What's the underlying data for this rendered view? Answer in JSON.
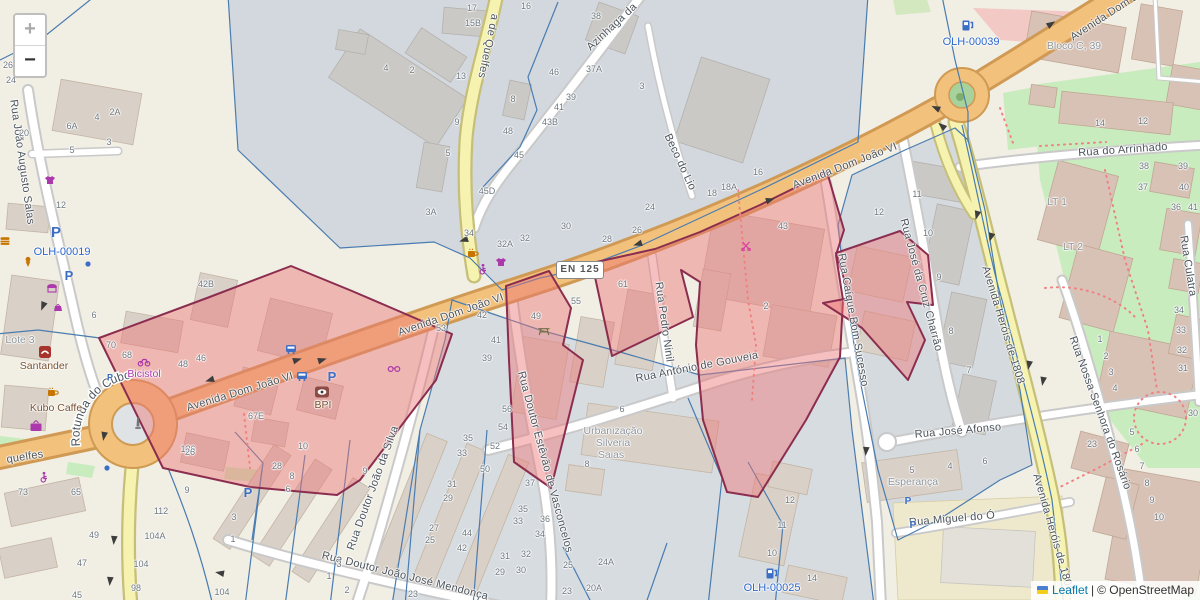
{
  "map": {
    "controls": {
      "zoom_in": "+",
      "zoom_out": "−"
    },
    "attribution": {
      "leaflet_link": "Leaflet",
      "separator": "|",
      "osm_text": "© OpenStreetMap"
    },
    "road_shield": "EN 125",
    "rotunda_label": "Rotunda do Cubo",
    "colors": {
      "highlight_fill": "#ee7676",
      "highlight_stroke": "#8b2d4f",
      "parcel_line": "#4a7cb0",
      "asset_label": "#2a66cc",
      "primary_road": "#f2c17c",
      "secondary_road": "#f6f2b0",
      "park": "#c9ecbf",
      "shop_label": "#ac39ac",
      "amenity_label": "#7a5230",
      "place_label": "#8d959c"
    },
    "street_labels": [
      {
        "t": "Avenida Dom João VI",
        "x": 451,
        "y": 315,
        "r": -19
      },
      {
        "t": "Avenida Dom João VI",
        "x": 845,
        "y": 166,
        "r": -21
      },
      {
        "t": "Avenida Dom João VI",
        "x": 240,
        "y": 392,
        "r": -17
      },
      {
        "t": "Avenida Dom João VI",
        "x": 1118,
        "y": 8,
        "r": -33
      },
      {
        "t": "Beco do Lio",
        "x": 680,
        "y": 162,
        "r": 65
      },
      {
        "t": "Azinhaga da",
        "x": 612,
        "y": 27,
        "r": -43
      },
      {
        "t": "a de Quelfes",
        "x": 488,
        "y": 46,
        "r": 102
      },
      {
        "t": "quelfes",
        "x": 25,
        "y": 457,
        "r": -9
      },
      {
        "t": "Rua João Augusto Salas",
        "x": 22,
        "y": 162,
        "r": 82
      },
      {
        "t": "Rua Pedro Ninil",
        "x": 664,
        "y": 322,
        "r": 82
      },
      {
        "t": "Rua António de Gouveia",
        "x": 697,
        "y": 367,
        "r": -11
      },
      {
        "t": "Rua Caíque Bom Sucesso",
        "x": 853,
        "y": 320,
        "r": 80
      },
      {
        "t": "Rua José da Cruz Charrão",
        "x": 921,
        "y": 285,
        "r": 75
      },
      {
        "t": "Avenida Heróis de 1808",
        "x": 1003,
        "y": 325,
        "r": 73
      },
      {
        "t": "Avenida Heróis de 1808",
        "x": 1053,
        "y": 533,
        "r": 74
      },
      {
        "t": "Rua do Arrinhado",
        "x": 1123,
        "y": 150,
        "r": -4
      },
      {
        "t": "Rua Culatra",
        "x": 1188,
        "y": 266,
        "r": 81
      },
      {
        "t": "Rua Nossa Senhora do Rosário",
        "x": 1100,
        "y": 413,
        "r": 70
      },
      {
        "t": "Rua José Afonso",
        "x": 958,
        "y": 431,
        "r": -5
      },
      {
        "t": "Rua Miguel do Ó",
        "x": 952,
        "y": 519,
        "r": -5
      },
      {
        "t": "Rua Doutor João da Silva",
        "x": 373,
        "y": 488,
        "r": -70
      },
      {
        "t": "Rua Doutor Estêvão de Vasconcelos",
        "x": 545,
        "y": 462,
        "r": 75
      },
      {
        "t": "Rua Doutor João José Mendonça",
        "x": 405,
        "y": 576,
        "r": 14
      }
    ],
    "poi_labels": [
      {
        "t": "Santander",
        "x": 44,
        "y": 366,
        "c": "amen"
      },
      {
        "t": "Kubo Caffe",
        "x": 56,
        "y": 408,
        "c": "amen"
      },
      {
        "t": "Bicistol",
        "x": 144,
        "y": 374,
        "c": "shop"
      },
      {
        "t": "Lote 3",
        "x": 20,
        "y": 340,
        "c": "place"
      },
      {
        "t": "BPI",
        "x": 323,
        "y": 405,
        "c": "amen"
      },
      {
        "t": "Urbanização",
        "x": 613,
        "y": 431,
        "c": "place"
      },
      {
        "t": "Silveria",
        "x": 613,
        "y": 443,
        "c": "place"
      },
      {
        "t": "Saias",
        "x": 611,
        "y": 455,
        "c": "place"
      },
      {
        "t": "Esperança",
        "x": 913,
        "y": 482,
        "c": "place"
      },
      {
        "t": "Bloco C, 39",
        "x": 1074,
        "y": 46,
        "c": "place"
      },
      {
        "t": "LT 1",
        "x": 1057,
        "y": 202,
        "c": "place"
      },
      {
        "t": "LT 2",
        "x": 1073,
        "y": 247,
        "c": "place"
      }
    ],
    "asset_labels": [
      {
        "t": "OLH-00019",
        "x": 62,
        "y": 252
      },
      {
        "t": "OLH-00039",
        "x": 971,
        "y": 42
      },
      {
        "t": "OLH-00025",
        "x": 772,
        "y": 588
      }
    ],
    "house_numbers": [
      [
        "26",
        8,
        65
      ],
      [
        "24",
        11,
        80
      ],
      [
        "20",
        24,
        133
      ],
      [
        "6A",
        72,
        126
      ],
      [
        "4",
        97,
        117
      ],
      [
        "2A",
        115,
        112
      ],
      [
        "5",
        72,
        150
      ],
      [
        "3",
        109,
        142
      ],
      [
        "12",
        61,
        205
      ],
      [
        "17",
        472,
        8
      ],
      [
        "15B",
        473,
        23
      ],
      [
        "16",
        526,
        6
      ],
      [
        "38",
        596,
        16
      ],
      [
        "4",
        386,
        68
      ],
      [
        "2",
        412,
        70
      ],
      [
        "13",
        461,
        76
      ],
      [
        "46",
        554,
        72
      ],
      [
        "37A",
        594,
        69
      ],
      [
        "3",
        642,
        86
      ],
      [
        "8",
        513,
        99
      ],
      [
        "39",
        571,
        97
      ],
      [
        "41",
        559,
        107
      ],
      [
        "43B",
        550,
        122
      ],
      [
        "48",
        508,
        131
      ],
      [
        "9",
        457,
        122
      ],
      [
        "45",
        519,
        155
      ],
      [
        "5",
        448,
        153
      ],
      [
        "45D",
        487,
        191
      ],
      [
        "3A",
        431,
        212
      ],
      [
        "34",
        469,
        233
      ],
      [
        "32A",
        505,
        244
      ],
      [
        "32",
        525,
        238
      ],
      [
        "30",
        566,
        226
      ],
      [
        "28",
        607,
        239
      ],
      [
        "26",
        637,
        230
      ],
      [
        "24",
        650,
        207
      ],
      [
        "18",
        712,
        193
      ],
      [
        "18A",
        729,
        187
      ],
      [
        "16",
        758,
        172
      ],
      [
        "42B",
        206,
        284
      ],
      [
        "6",
        94,
        315
      ],
      [
        "70",
        111,
        345
      ],
      [
        "68",
        127,
        355
      ],
      [
        "48",
        183,
        364
      ],
      [
        "46",
        201,
        358
      ],
      [
        "67E",
        256,
        416
      ],
      [
        "126",
        188,
        449
      ],
      [
        "73",
        23,
        492
      ],
      [
        "65",
        76,
        492
      ],
      [
        "49",
        94,
        535
      ],
      [
        "47",
        82,
        563
      ],
      [
        "45",
        77,
        595
      ],
      [
        "112",
        161,
        511
      ],
      [
        "104A",
        155,
        536
      ],
      [
        "104",
        141,
        564
      ],
      [
        "98",
        136,
        588
      ],
      [
        "9",
        187,
        490
      ],
      [
        "3",
        234,
        517
      ],
      [
        "1",
        233,
        539
      ],
      [
        "104",
        222,
        592
      ],
      [
        "53",
        441,
        328
      ],
      [
        "42",
        482,
        315
      ],
      [
        "41",
        496,
        340
      ],
      [
        "39",
        487,
        358
      ],
      [
        "49",
        536,
        316
      ],
      [
        "55",
        576,
        301
      ],
      [
        "61",
        623,
        284
      ],
      [
        "6",
        622,
        409
      ],
      [
        "2",
        766,
        306
      ],
      [
        "43",
        783,
        226
      ],
      [
        "12",
        879,
        212
      ],
      [
        "11",
        917,
        194
      ],
      [
        "10",
        928,
        233
      ],
      [
        "9",
        939,
        277
      ],
      [
        "8",
        951,
        331
      ],
      [
        "7",
        969,
        370
      ],
      [
        "14",
        1100,
        123
      ],
      [
        "12",
        1143,
        121
      ],
      [
        "38",
        1144,
        166
      ],
      [
        "39",
        1183,
        166
      ],
      [
        "37",
        1143,
        187
      ],
      [
        "40",
        1184,
        187
      ],
      [
        "36",
        1176,
        207
      ],
      [
        "41",
        1193,
        207
      ],
      [
        "34",
        1179,
        310
      ],
      [
        "33",
        1181,
        330
      ],
      [
        "32",
        1182,
        350
      ],
      [
        "31",
        1183,
        368
      ],
      [
        "30",
        1193,
        413
      ],
      [
        "1",
        1100,
        339
      ],
      [
        "2",
        1106,
        356
      ],
      [
        "3",
        1111,
        372
      ],
      [
        "4",
        1115,
        388
      ],
      [
        "5",
        1132,
        432
      ],
      [
        "6",
        1137,
        449
      ],
      [
        "7",
        1142,
        466
      ],
      [
        "8",
        1147,
        483
      ],
      [
        "9",
        1152,
        500
      ],
      [
        "10",
        1159,
        517
      ],
      [
        "23",
        1092,
        444
      ],
      [
        "56",
        507,
        409
      ],
      [
        "54",
        503,
        427
      ],
      [
        "52",
        495,
        446
      ],
      [
        "50",
        485,
        469
      ],
      [
        "37",
        530,
        483
      ],
      [
        "8",
        587,
        464
      ],
      [
        "35",
        523,
        509
      ],
      [
        "33",
        518,
        521
      ],
      [
        "36",
        545,
        519
      ],
      [
        "34",
        540,
        534
      ],
      [
        "31",
        505,
        556
      ],
      [
        "32",
        526,
        554
      ],
      [
        "29",
        500,
        572
      ],
      [
        "30",
        521,
        570
      ],
      [
        "25",
        568,
        565
      ],
      [
        "24A",
        606,
        562
      ],
      [
        "23",
        567,
        591
      ],
      [
        "20A",
        594,
        588
      ],
      [
        "26",
        190,
        452
      ],
      [
        "10",
        303,
        446
      ],
      [
        "28",
        277,
        466
      ],
      [
        "8",
        292,
        476
      ],
      [
        "6",
        288,
        489
      ],
      [
        "9",
        365,
        471
      ],
      [
        "35",
        468,
        438
      ],
      [
        "33",
        462,
        453
      ],
      [
        "31",
        452,
        484
      ],
      [
        "29",
        448,
        498
      ],
      [
        "27",
        434,
        528
      ],
      [
        "25",
        430,
        540
      ],
      [
        "44",
        467,
        533
      ],
      [
        "42",
        462,
        548
      ],
      [
        "3",
        339,
        564
      ],
      [
        "1",
        329,
        576
      ],
      [
        "2",
        347,
        590
      ],
      [
        "23",
        413,
        594
      ],
      [
        "5",
        912,
        470
      ],
      [
        "4",
        950,
        466
      ],
      [
        "6",
        985,
        461
      ],
      [
        "12",
        790,
        500
      ],
      [
        "11",
        782,
        525
      ],
      [
        "10",
        772,
        553
      ],
      [
        "14",
        812,
        578
      ]
    ],
    "icons": [
      [
        "parking",
        56,
        233,
        15
      ],
      [
        "parking",
        69,
        276,
        13
      ],
      [
        "parking",
        332,
        377,
        13
      ],
      [
        "parking",
        248,
        493,
        13
      ],
      [
        "parking",
        110,
        377,
        9
      ],
      [
        "parking",
        908,
        501,
        10
      ],
      [
        "parking",
        913,
        525,
        10
      ],
      [
        "bus",
        291,
        349
      ],
      [
        "bus",
        302,
        376
      ],
      [
        "charging",
        968,
        25
      ],
      [
        "charging",
        772,
        573
      ],
      [
        "tshirt",
        50,
        180
      ],
      [
        "tshirt",
        501,
        262
      ],
      [
        "tv",
        36,
        426
      ],
      [
        "moto",
        144,
        362
      ],
      [
        "awning",
        52,
        288
      ],
      [
        "bag",
        58,
        307
      ],
      [
        "icecream",
        28,
        262
      ],
      [
        "fastfood",
        5,
        241
      ],
      [
        "wheelchair",
        483,
        269
      ],
      [
        "wheelchair",
        44,
        477
      ],
      [
        "cup",
        473,
        253
      ],
      [
        "cup",
        53,
        392
      ],
      [
        "glasses",
        394,
        369
      ],
      [
        "hairdresser",
        746,
        246
      ],
      [
        "picnic",
        544,
        331
      ],
      [
        "monument",
        138,
        424
      ],
      [
        "dot",
        88,
        264
      ],
      [
        "dot",
        107,
        468
      ],
      [
        "bank-santander",
        45,
        352
      ],
      [
        "bank-bpi",
        322,
        392
      ]
    ],
    "arrows": [
      [
        210,
        380,
        163
      ],
      [
        297,
        360,
        -17
      ],
      [
        322,
        360,
        -17
      ],
      [
        464,
        240,
        163
      ],
      [
        638,
        244,
        163
      ],
      [
        770,
        200,
        -17
      ],
      [
        1051,
        24,
        -33
      ],
      [
        936,
        108,
        205
      ],
      [
        942,
        126,
        220
      ],
      [
        977,
        215,
        105
      ],
      [
        991,
        237,
        107
      ],
      [
        1029,
        365,
        100
      ],
      [
        1043,
        381,
        100
      ],
      [
        104,
        436,
        100
      ],
      [
        114,
        540,
        95
      ],
      [
        110,
        581,
        95
      ],
      [
        866,
        451,
        95
      ],
      [
        43,
        306,
        112
      ],
      [
        220,
        573,
        190
      ]
    ]
  }
}
